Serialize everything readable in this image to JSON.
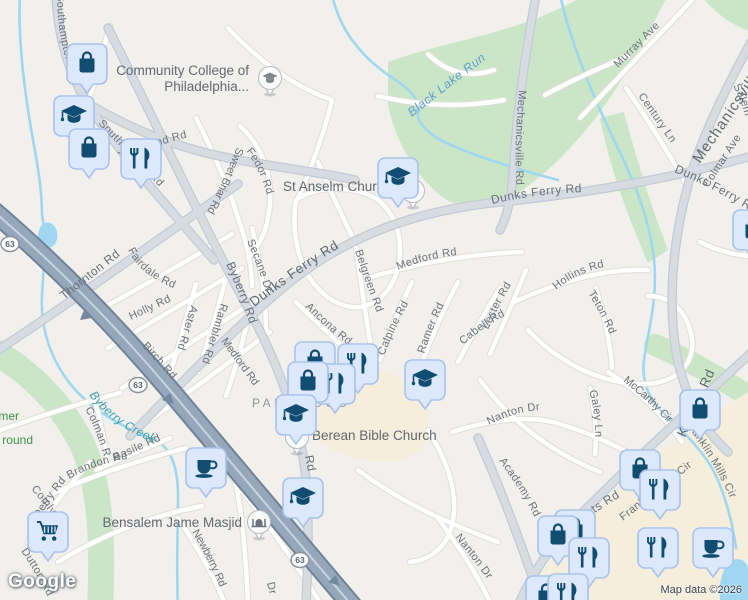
{
  "chrome": {
    "logo": "Google",
    "attribution": "Map data ©2026",
    "route_shield": "63"
  },
  "pois": {
    "community_college_line1": "Community College of",
    "community_college_line2": "Philadelphia...",
    "st_anselm": "St Anselm Church",
    "berean": "Berean Bible Church",
    "masjid": "Bensalem Jame Masjid",
    "neighborhood": "PARKWOOD",
    "park_fragment_line1": "mer",
    "park_fragment_line2": "round"
  },
  "water": {
    "black_lake_run": "Black Lake Run",
    "byberry_creek": "Byberry Creek"
  },
  "roads": {
    "dunks_ferry_1": "Dunks Ferry Rd",
    "dunks_ferry_2": "Dunks Ferry Rd",
    "dunks_ferry_3": "Dunks Ferry Rd",
    "byberry": "Byberry Rd",
    "byberry_fragment": "Rd",
    "southampton_1": "Southampton Rd",
    "southampton_2": "Southampton Rd",
    "townsend": "Townsend Rd",
    "thornton": "Thornton Rd",
    "fairdale": "Fairdale Rd",
    "holly": "Holly Rd",
    "aster": "Aster Rd",
    "rambler": "Rambler Rd",
    "birch": "Birch Rd",
    "medford_1": "Medford Rd",
    "medford_2": "Medford Rd",
    "sweet_briar": "Sweet Briar Rd",
    "fedor": "Fedor Rd",
    "secane": "Secane Dr",
    "belgreen": "Belgreen Rd",
    "ancona": "Ancona Rd",
    "calpine": "Calpine Rd",
    "ramer": "Ramer Rd",
    "cabell": "Cabell Rd",
    "lester": "Lester Rd",
    "hollins": "Hollins Rd",
    "teton": "Teton Rd",
    "mechanicsville_1": "Mechanicsville Rd",
    "mechanicsville_2": "Mechanicsville Rd",
    "murray": "Murray Ave",
    "century": "Century Ln",
    "colmar": "Colmar Ave",
    "salem": "Salem",
    "mccarthy": "McCarthy Cir",
    "nanton_1": "Nanton Dr",
    "nanton_2": "Nanton Dr",
    "galey": "Galey Ln",
    "franklin_1": "Franklin Mills Cir",
    "franklin_2": "Franklin Mills Cir",
    "knights_1": "Knights Rd",
    "knights_2": "Knights Rd",
    "academy": "Academy Rd",
    "newberry": "Newberry Rd",
    "basile": "Basile Rd",
    "colman": "Colman Rd",
    "brandon": "Brandon Rd",
    "derry": "Derry Rd",
    "comly": "Comly Rd",
    "dutton": "Dutton Rd",
    "dr_fragment": "Dr"
  },
  "poi_marker_types": [
    "shopping-bag",
    "graduation-cap",
    "restaurant",
    "coffee-cup",
    "shopping-cart",
    "mosque-circle",
    "school-circle",
    "church-circle"
  ],
  "palette": {
    "land": "#f2f0ed",
    "park_green": "#cbe6c7",
    "commercial_beige": "#f5eedd",
    "water_blue": "#9fd7f0",
    "highway_blue_gray": "#96a7bb",
    "marker_fill": "#dce8fb",
    "marker_border": "#a9c2ec",
    "marker_icon": "#114d70",
    "road_label_gray": "#6b727b"
  }
}
